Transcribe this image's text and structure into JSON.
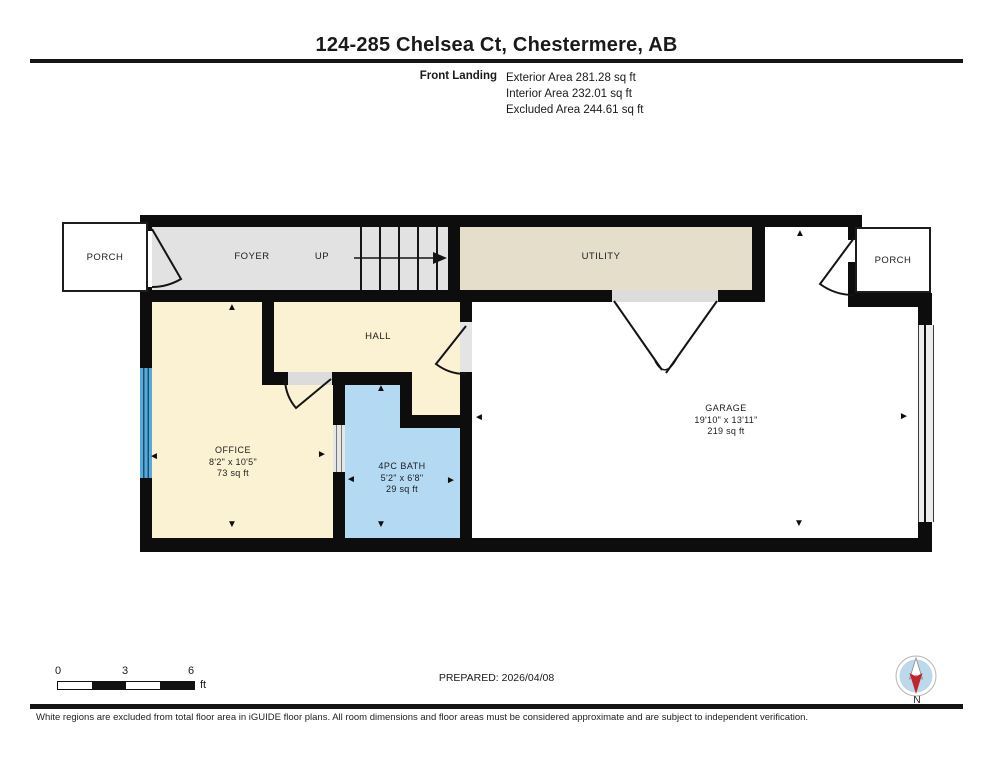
{
  "header": {
    "title": "124-285 Chelsea Ct, Chestermere, AB",
    "floor_label": "Front Landing",
    "area_lines": [
      "Exterior Area 281.28 sq ft",
      "Interior Area 232.01 sq ft",
      "Excluded Area 244.61 sq ft"
    ]
  },
  "plan": {
    "porch_left": "PORCH",
    "foyer": "FOYER",
    "up": "UP",
    "utility": "UTILITY",
    "porch_right": "PORCH",
    "hall": "HALL",
    "office": {
      "name": "OFFICE",
      "dims": "8'2\" x 10'5\"",
      "area": "73 sq ft"
    },
    "bath": {
      "name": "4PC BATH",
      "dims": "5'2\" x 6'8\"",
      "area": "29 sq ft"
    },
    "garage": {
      "name": "GARAGE",
      "dims": "19'10\" x 13'11\"",
      "area": "219 sq ft"
    }
  },
  "footer": {
    "scale_ticks": [
      "0",
      "3",
      "6"
    ],
    "scale_unit": "ft",
    "prepared": "PREPARED: 2026/04/08",
    "compass_label": "N",
    "disclaimer": "White regions are excluded from total floor area in iGUIDE floor plans. All room dimensions and floor areas must be considered approximate and are subject to independent verification."
  },
  "colors": {
    "wall": "#0d0d0d",
    "room_gray": "#e2e2e2",
    "room_tan": "#e5decb",
    "room_cream": "#fbf2d3",
    "room_blue": "#b4daf3",
    "window_blue": "#55aadc",
    "compass_red": "#c4232b",
    "compass_blue": "#bcd9ec"
  }
}
